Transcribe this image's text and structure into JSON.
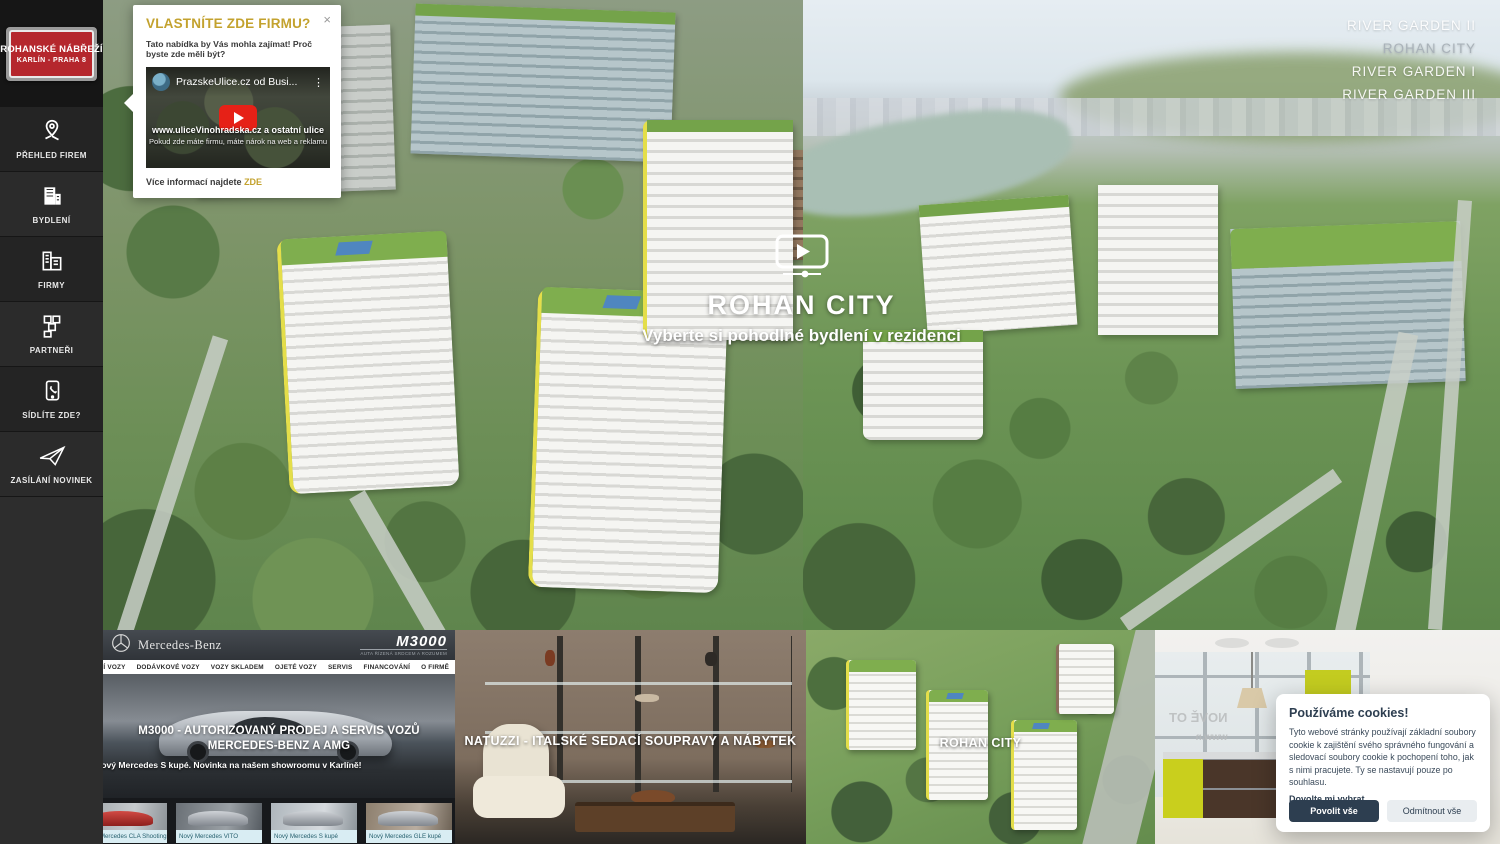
{
  "colors": {
    "accent_gold": "#C3A22E",
    "sign_red": "#B5272D",
    "youtube_red": "#E62117",
    "cookie_navy": "#2D3E50",
    "facebook_blue": "#3B5998",
    "sidebar_dark": "#242424",
    "roof_green": "#7FAE4E",
    "accent_yellow": "#E4DE4A"
  },
  "icons": {
    "close": "×",
    "more": "⋮",
    "facebook_f": "f"
  },
  "sidebar": {
    "logo": {
      "line1": "ROHANSKÉ NÁBŘEŽÍ",
      "line2": "KARLÍN - PRAHA 8"
    },
    "items": [
      {
        "label": "PŘEHLED FIREM",
        "icon": "map-pin"
      },
      {
        "label": "BYDLENÍ",
        "icon": "apartment-building"
      },
      {
        "label": "FIRMY",
        "icon": "office-buildings"
      },
      {
        "label": "PARTNEŘI",
        "icon": "blocks-grid"
      },
      {
        "label": "SÍDLÍTE ZDE?",
        "icon": "phone"
      },
      {
        "label": "ZASÍLÁNÍ NOVINEK",
        "icon": "paper-plane"
      }
    ]
  },
  "popup": {
    "title": "VLASTNÍTE ZDE FIRMU?",
    "intro": "Tato nabídka by Vás mohla zajímat! Proč byste zde měli být?",
    "video": {
      "channel_title": "PrazskeUlice.cz od Busi...",
      "overlay_line1": "www.uliceVinohradska.cz a ostatní ulice",
      "overlay_line2": "Pokud zde máte firmu, máte nárok na web a reklamu"
    },
    "footer_text": "Více informací najdete",
    "footer_link": "ZDE"
  },
  "hero": {
    "nav": [
      {
        "label": "RIVER GARDEN II"
      },
      {
        "label": "ROHAN CITY"
      },
      {
        "label": "RIVER GARDEN I"
      },
      {
        "label": "RIVER GARDEN III"
      }
    ],
    "title": "ROHAN CITY",
    "subtitle": "Vyberte si pohodlné bydlení v rezidenci"
  },
  "tiles": {
    "mercedes": {
      "brand": "Mercedes-Benz",
      "logo": "M3000",
      "logo_tagline": "AUTA ŘÍZENÁ SRDCEM A ROZUMEM",
      "nav": [
        "OSOBNÍ VOZY",
        "DODÁVKOVÉ VOZY",
        "VOZY SKLADEM",
        "OJETÉ VOZY",
        "SERVIS",
        "FINANCOVÁNÍ",
        "O FIRMĚ",
        "KONTAKTY",
        "NOVINKY"
      ],
      "facebook_label": "Facebook",
      "title": "M3000 - AUTORIZOVANÝ PRODEJ A SERVIS VOZŮ MERCEDES-BENZ A AMG",
      "subtitle": "Nový Mercedes S kupé. Novinka na našem showroomu v Karlíně!",
      "thumbs": [
        {
          "caption": "Nový Mercedes CLA Shooting Brake"
        },
        {
          "caption": "Nový Mercedes VITO"
        },
        {
          "caption": "Nový Mercedes S kupé"
        },
        {
          "caption": "Nový Mercedes GLE kupé"
        }
      ]
    },
    "natuzzi": {
      "title": "NATUZZI - ITALSKÉ SEDACÍ SOUPRAVY A NÁBYTEK"
    },
    "rohan": {
      "title": "ROHAN CITY"
    },
    "kitchen": {
      "window_sign_line1": "NOVĚ OT",
      "window_sign_line2": "www.n"
    },
    "cookies": {
      "title": "Používáme cookies!",
      "body": "Tyto webové stránky používají základní soubory cookie k zajištění svého správného fungování a sledovací soubory cookie k pochopení toho, jak s nimi pracujete. Ty se nastavují pouze po souhlasu.",
      "link": "Dovolte mi vybrat",
      "accept": "Povolit vše",
      "decline": "Odmítnout vše"
    }
  }
}
